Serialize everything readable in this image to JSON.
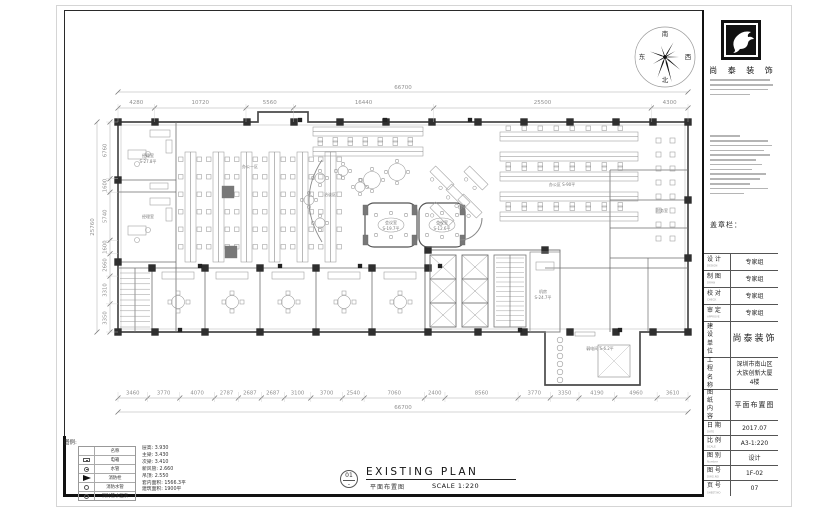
{
  "compass": {
    "top": "南",
    "right": "西",
    "bottom": "北",
    "left": "东"
  },
  "dimensions": {
    "top": [
      "4280",
      "10720",
      "5560",
      "16440",
      "25500",
      "4300"
    ],
    "top_total": "66700",
    "bottom": [
      "3460",
      "3770",
      "4070",
      "2787",
      "2687",
      "2687",
      "3100",
      "3700",
      "2540",
      "7060",
      "2400",
      "8560",
      "3770",
      "3350",
      "4190",
      "4960",
      "3610"
    ],
    "bottom_total": "66700",
    "left": [
      "6760",
      "1600",
      "5740",
      "1600",
      "2660",
      "3310",
      "3350"
    ],
    "left_total": "25760"
  },
  "plan": {
    "labels": [
      {
        "text": "经理室",
        "x": 148,
        "y": 157
      },
      {
        "text": "S-27.8平",
        "x": 148,
        "y": 163
      },
      {
        "text": "经理室",
        "x": 148,
        "y": 218
      },
      {
        "text": "办公一区",
        "x": 250,
        "y": 168
      },
      {
        "text": "洽谈区",
        "x": 330,
        "y": 196
      },
      {
        "text": "会议室",
        "x": 391,
        "y": 224
      },
      {
        "text": "S-19.7平",
        "x": 391,
        "y": 230
      },
      {
        "text": "会议室",
        "x": 442,
        "y": 224
      },
      {
        "text": "S-12.6平",
        "x": 442,
        "y": 230
      },
      {
        "text": "办公区 S-90平",
        "x": 562,
        "y": 186
      },
      {
        "text": "财务室",
        "x": 662,
        "y": 212
      },
      {
        "text": "机房",
        "x": 543,
        "y": 293
      },
      {
        "text": "S-24.7平",
        "x": 543,
        "y": 299
      },
      {
        "text": "弱电间 S-6.2平",
        "x": 600,
        "y": 350
      }
    ]
  },
  "logo": {
    "company": "尚 泰 装 饰"
  },
  "title_block": {
    "stamp_label": "盖章栏：",
    "rows": [
      {
        "label": "设 计",
        "sub": "DESIGN",
        "value": "专家组",
        "h": 17,
        "style": ""
      },
      {
        "label": "制 图",
        "sub": "DRAW",
        "value": "专家组",
        "h": 17,
        "style": ""
      },
      {
        "label": "校 对",
        "sub": "CHECK",
        "value": "专家组",
        "h": 17,
        "style": ""
      },
      {
        "label": "审 定",
        "sub": "APPROVE",
        "value": "专家组",
        "h": 17,
        "style": ""
      },
      {
        "label": "建设单位",
        "sub": "",
        "value": "尚泰装饰",
        "h": 36,
        "style": "big",
        "stack": true
      },
      {
        "label": "工程名称",
        "sub": "",
        "value": "深圳市南山区\n大族创新大厦\n4楼",
        "h": 32,
        "style": "",
        "stack": true
      },
      {
        "label": "图纸内容",
        "sub": "",
        "value": "平面布置图",
        "h": 31,
        "style": "med",
        "stack": true
      },
      {
        "label": "日 期",
        "sub": "DATE",
        "value": "2017.07",
        "h": 15,
        "style": ""
      },
      {
        "label": "比 例",
        "sub": "SCALE",
        "value": "A3-1:220",
        "h": 15,
        "style": ""
      },
      {
        "label": "图 别",
        "sub": "Number",
        "value": "设计",
        "h": 15,
        "style": ""
      },
      {
        "label": "图 号",
        "sub": "DWG.NO",
        "value": "1F-02",
        "h": 15,
        "style": ""
      },
      {
        "label": "页 号",
        "sub": "SHEET.NO",
        "value": "07",
        "h": 16,
        "style": ""
      }
    ]
  },
  "legend": {
    "title": "图例:",
    "header": "名称",
    "items": [
      {
        "icon": "panel",
        "name": "电箱"
      },
      {
        "icon": "circle-dot",
        "name": "水管"
      },
      {
        "icon": "hydrant",
        "name": "消防栓"
      },
      {
        "icon": "circle",
        "name": "消防水管"
      },
      {
        "icon": "circle",
        "name": "消防管水压表"
      }
    ],
    "specs": [
      "层高: 3.930",
      "主梁: 3.430",
      "次梁: 3.410",
      "新风管: 2.660",
      "吊顶: 2.550",
      "套内面积: 1566.3平",
      "建筑面积: 1900平"
    ]
  },
  "footer": {
    "number": "01",
    "title": "EXISTING PLAN",
    "subtitle": "平面布置图",
    "scale": "SCALE 1:220"
  }
}
